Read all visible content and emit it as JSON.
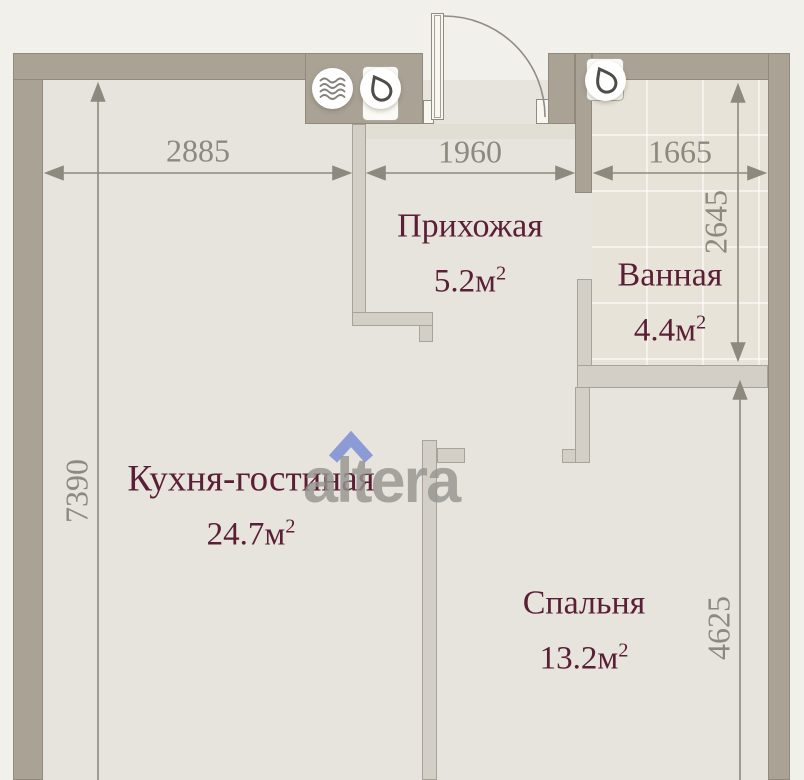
{
  "watermark": {
    "text": "altera"
  },
  "rooms": [
    {
      "id": "hallway",
      "name": "Прихожая",
      "area": "5.2м",
      "area_sup": "2"
    },
    {
      "id": "bathroom",
      "name": "Ванная",
      "area": "4.4м",
      "area_sup": "2"
    },
    {
      "id": "kitchen_living",
      "name": "Кухня-гостиная",
      "area": "24.7м",
      "area_sup": "2"
    },
    {
      "id": "bedroom",
      "name": "Спальня",
      "area": "13.2м",
      "area_sup": "2"
    }
  ],
  "dimensions_mm": {
    "top_left": "2885",
    "top_center": "1960",
    "top_right": "1665",
    "left_side": "7390",
    "right_upper": "2645",
    "right_lower": "4625"
  },
  "icons": [
    {
      "name": "ventilation-waves-icon"
    },
    {
      "name": "water-drop-icon"
    },
    {
      "name": "water-drop-icon"
    }
  ],
  "colors": {
    "background": "#f1f0ea",
    "wall": "#a9a295",
    "floor": "#e7e4dd",
    "bathroom_floor": "#e8e3d8",
    "partition": "#d3cfc7",
    "dimension_text": "#8d897f",
    "room_label": "#5a1f36",
    "logo_gray": "#96958f",
    "logo_blue": "#8c9bd6"
  }
}
